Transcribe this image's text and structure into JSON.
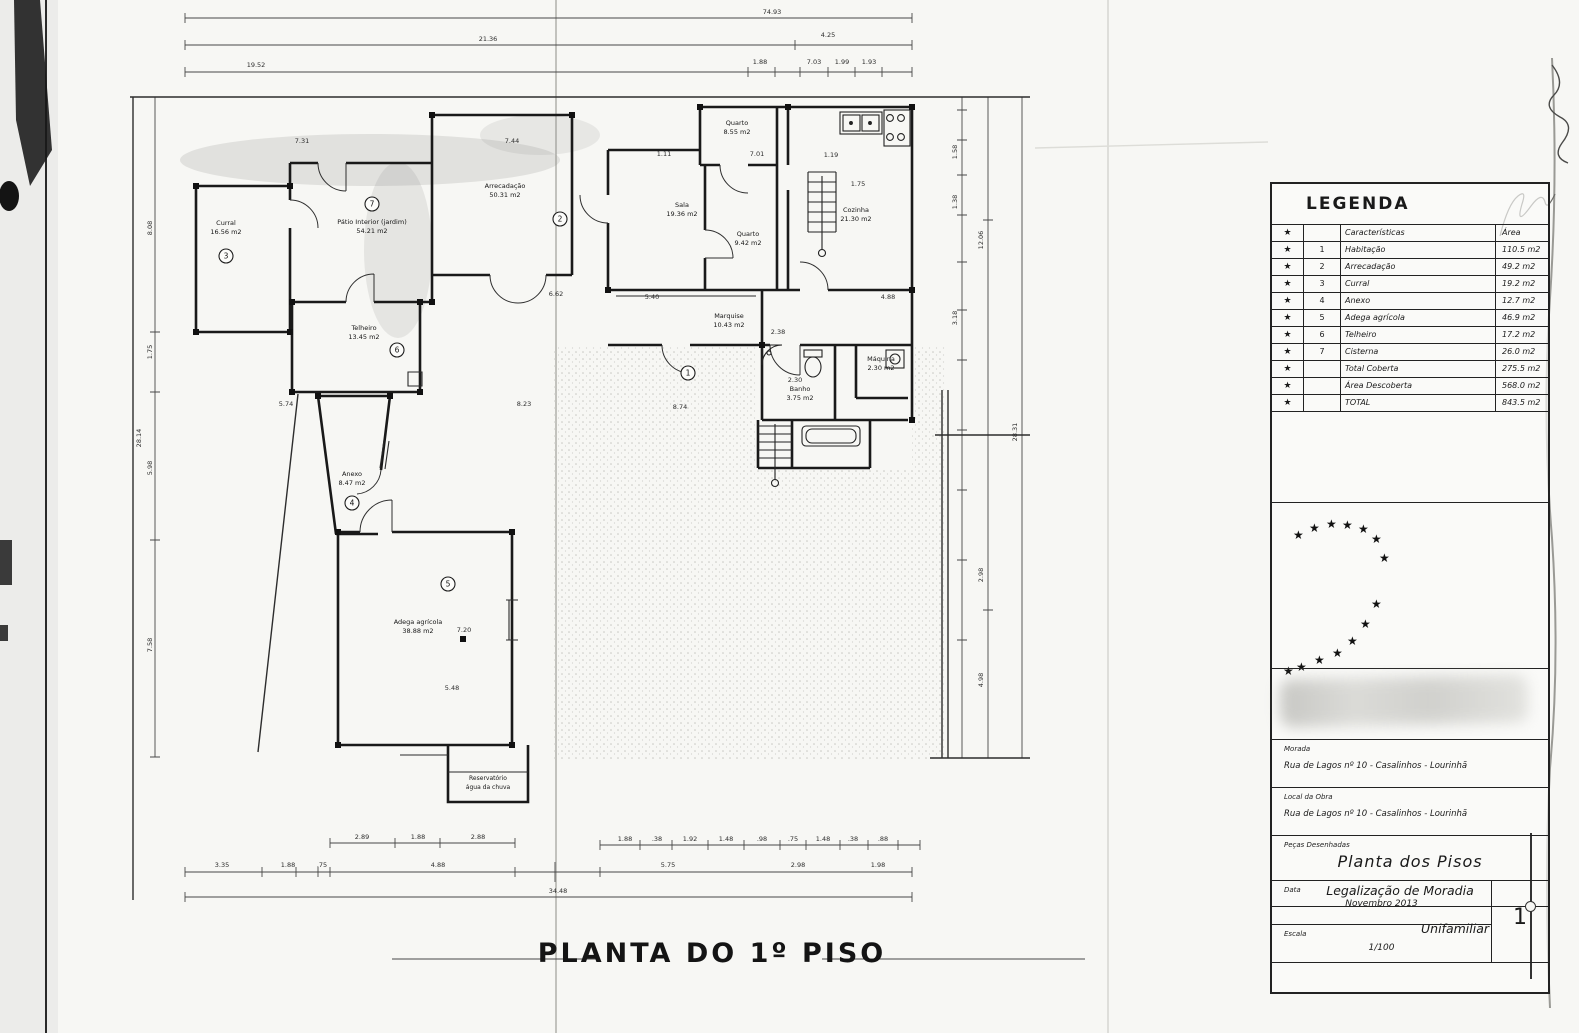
{
  "plan": {
    "title": "PLANTA DO 1º PISO",
    "rooms": {
      "curral": {
        "name": "Curral",
        "area": "16.56 m2",
        "num": "3"
      },
      "patio_interior": {
        "name": "Pátio Interior (jardim)",
        "area": "54.21 m2",
        "num": "7"
      },
      "arrecadacao": {
        "name": "Arrecadação",
        "area": "50.31 m2",
        "num": "2"
      },
      "sala": {
        "name": "Sala",
        "area": "19.36 m2",
        "num": ""
      },
      "quarto_1": {
        "name": "Quarto",
        "area": "8.55 m2",
        "num": ""
      },
      "quarto_2": {
        "name": "Quarto",
        "area": "9.42 m2",
        "num": ""
      },
      "cozinha": {
        "name": "Cozinha",
        "area": "21.30 m2",
        "num": ""
      },
      "marquise": {
        "name": "Marquise",
        "area": "10.43 m2",
        "num": ""
      },
      "banho": {
        "name": "Banho",
        "area": "3.75 m2",
        "num": ""
      },
      "maquina": {
        "name": "Máquina",
        "area": "2.30 m2",
        "num": ""
      },
      "telheiro": {
        "name": "Telheiro",
        "area": "13.45 m2",
        "num": "6"
      },
      "anexo": {
        "name": "Anexo",
        "area": "8.47 m2",
        "num": "4"
      },
      "adega": {
        "name": "Adega agrícola",
        "area": "38.88 m2",
        "num": "5"
      },
      "patio_exterior": {
        "name": "",
        "area": "",
        "num": "1"
      }
    },
    "note": {
      "line1": "Reservatório",
      "line2": "água da chuva"
    },
    "dimensions": {
      "top": [
        "74.93",
        "21.36",
        "4.25",
        "19.52",
        "1.88",
        "7.03",
        "1.99",
        "1.93"
      ],
      "left": [
        "8.08",
        "1.75",
        "5.98",
        "7.58",
        "28.14"
      ],
      "right": [
        "1.58",
        "1.38",
        "3.18",
        "12.06",
        "2.98",
        "4.98",
        "28.31"
      ],
      "bottom": [
        "2.89",
        "1.88",
        "2.88",
        "3.35",
        "1.88",
        ".75",
        "4.88",
        "1.88",
        ".38",
        "1.92",
        "1.48",
        ".98",
        ".75",
        "1.48",
        ".38",
        ".88",
        "5.75",
        "2.98",
        "1.98",
        "34.48"
      ],
      "interior": [
        "7.31",
        "7.44",
        "1.11",
        "7.01",
        "1.19",
        "6.62",
        "5.40",
        "4.88",
        "8.23",
        "8.74",
        "5.74",
        "2.38",
        "2.30",
        "1.75",
        "5.48",
        "7.20"
      ]
    }
  },
  "legend": {
    "title": "LEGENDA",
    "header": {
      "num": "",
      "label": "Características",
      "area": "Área"
    },
    "rows": [
      {
        "num": "1",
        "label": "Habitação",
        "area": "110.5 m2"
      },
      {
        "num": "2",
        "label": "Arrecadação",
        "area": "49.2 m2"
      },
      {
        "num": "3",
        "label": "Curral",
        "area": "19.2 m2"
      },
      {
        "num": "4",
        "label": "Anexo",
        "area": "12.7 m2"
      },
      {
        "num": "5",
        "label": "Adega agrícola",
        "area": "46.9 m2"
      },
      {
        "num": "6",
        "label": "Telheiro",
        "area": "17.2 m2"
      },
      {
        "num": "7",
        "label": "Cisterna",
        "area": "26.0 m2"
      },
      {
        "num": "",
        "label": "Total Coberta",
        "area": "275.5 m2"
      },
      {
        "num": "",
        "label": "Área Descoberta",
        "area": "568.0 m2"
      },
      {
        "num": "",
        "label": "TOTAL",
        "area": "843.5 m2"
      }
    ]
  },
  "stamp": {
    "line1": "Legalização de Moradia",
    "line2": "Unifamiliar"
  },
  "titleblock": {
    "morada_label": "Morada",
    "morada_value": "Rua de Lagos nº 10  -  Casalinhos  -  Lourinhã",
    "obra_label": "Local da Obra",
    "obra_value": "Rua de Lagos nº 10  -  Casalinhos  -  Lourinhã",
    "pecas_label": "Peças Desenhadas",
    "pecas_value": "Planta dos Pisos",
    "data_label": "Data",
    "data_value": "Novembro 2013",
    "escala_label": "Escala",
    "escala_value": "1/100",
    "sheet_number": "1"
  }
}
